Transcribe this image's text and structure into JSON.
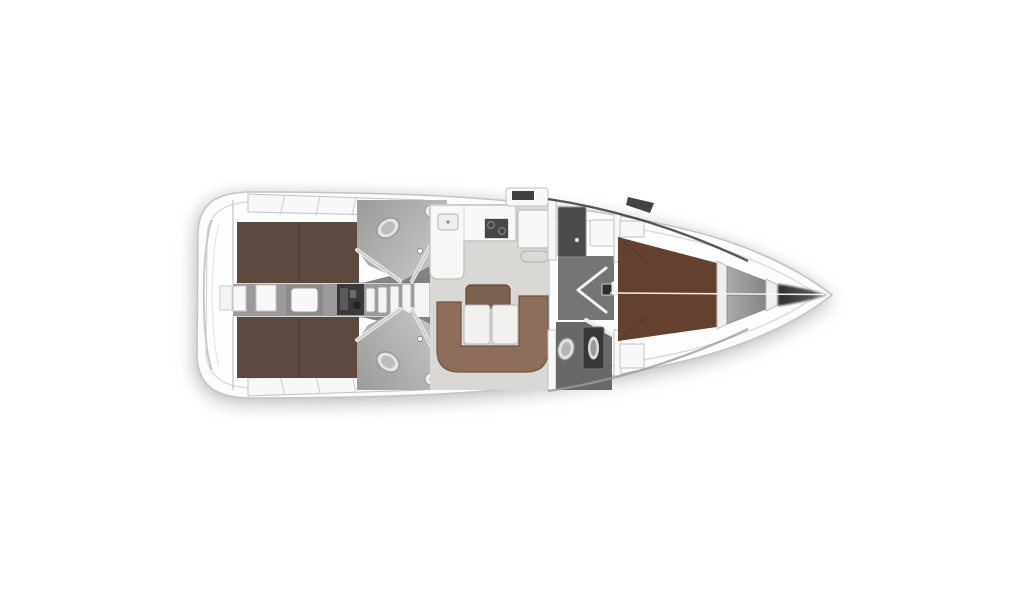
{
  "diagram": {
    "type": "floor-plan",
    "subject": "sailing-yacht-interior-layout",
    "orientation": "bow-right"
  },
  "colors": {
    "background": "#ffffff",
    "hull_fill": "#fcfcfc",
    "hull_stroke": "#c4c4c4",
    "inner_fill": "#fdfdfd",
    "inner_line": "#d6d6d6",
    "joinery_white": "#f8f8f8",
    "joinery_stroke": "#c2c2c2",
    "bed_aft": "#5c4a40",
    "bed_forward": "#64412f",
    "bed_seam": "#43352d",
    "settee": "#8c6e5a",
    "settee_edge": "#6e5542",
    "table": "#7d6150",
    "table_edge": "#5e4434",
    "cushion": "#f2f1ef",
    "cushion_stroke": "#b7b7b7",
    "salon_floor": "#dad8d5",
    "companionway_floor": "#9c9a98",
    "head_floor_aft": "#a8a8a8",
    "head_floor_forward": "#686868",
    "corridor_floor": "#757575",
    "engine_dark": "#3a3a3a",
    "stove_dark": "#474747",
    "locker_dark": "#4b4b4b",
    "shower_dark": "#383838",
    "anchor_locker": "#9a9a9a",
    "bow_shadow": "#2e2e2e",
    "fixture_light": "#e2e2e2",
    "fixture_stroke": "#949494",
    "step_fill": "#f4f4f4",
    "wedge_gray": "#757575",
    "sheer_dark": "#2e2e2e",
    "sheer_light": "#9b9b9b",
    "centerline_white": "#fafafa"
  },
  "areas": [
    {
      "id": "transom",
      "label": "Transom / swim platform"
    },
    {
      "id": "aft-cabin-port",
      "label": "Aft double cabin (top)"
    },
    {
      "id": "aft-cabin-starboard",
      "label": "Aft double cabin (bottom)"
    },
    {
      "id": "engine-compartment",
      "label": "Engine compartment"
    },
    {
      "id": "companionway-steps",
      "label": "Companionway steps"
    },
    {
      "id": "aft-head-port",
      "label": "Aft head / WC (top)"
    },
    {
      "id": "aft-head-starboard",
      "label": "Aft head / WC (bottom)"
    },
    {
      "id": "galley",
      "label": "L-shaped galley with stove and sink"
    },
    {
      "id": "nav-station",
      "label": "Navigation station"
    },
    {
      "id": "salon",
      "label": "Salon with U-shaped settee and table"
    },
    {
      "id": "corridor",
      "label": "Passageway with cabin doors"
    },
    {
      "id": "forward-head",
      "label": "Forward head with shower"
    },
    {
      "id": "forward-cabin",
      "label": "Forward cabin with V-berth"
    },
    {
      "id": "anchor-locker",
      "label": "Anchor locker"
    },
    {
      "id": "bow",
      "label": "Bow tip"
    }
  ]
}
